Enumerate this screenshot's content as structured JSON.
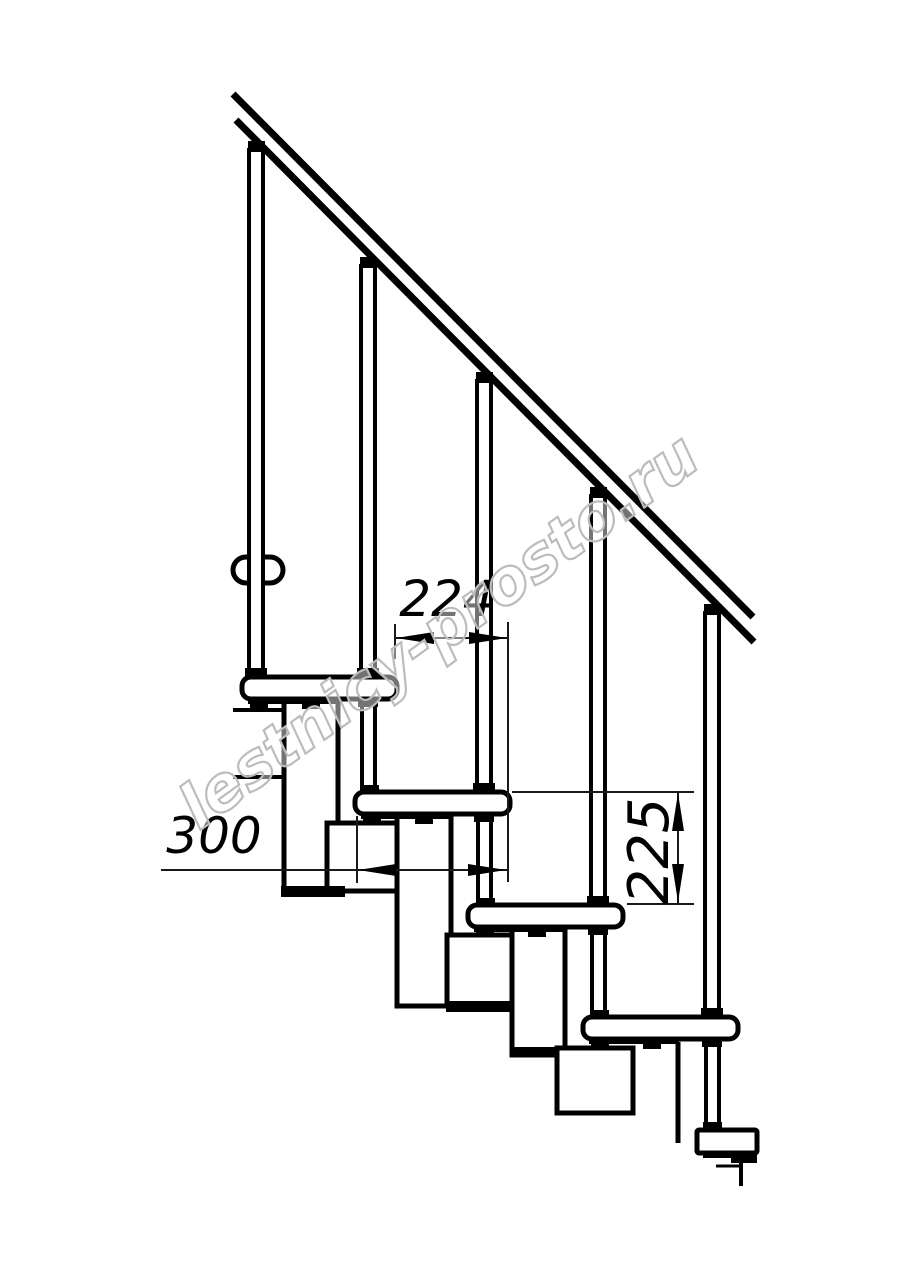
{
  "drawing": {
    "kind": "modular-staircase-side-elevation",
    "background": "#ffffff",
    "line_color": "#000000",
    "dim_color": "#1a1a1a",
    "watermark": {
      "text": "lestnicy-prosto.ru",
      "color": "#bcbcbc"
    },
    "dimensions": {
      "run": {
        "value": "224",
        "orientation": "horizontal"
      },
      "tread": {
        "value": "300",
        "orientation": "horizontal"
      },
      "rise": {
        "value": "225",
        "orientation": "vertical"
      }
    },
    "counts": {
      "steps": 5,
      "balusters": 5,
      "modules": 4
    }
  }
}
